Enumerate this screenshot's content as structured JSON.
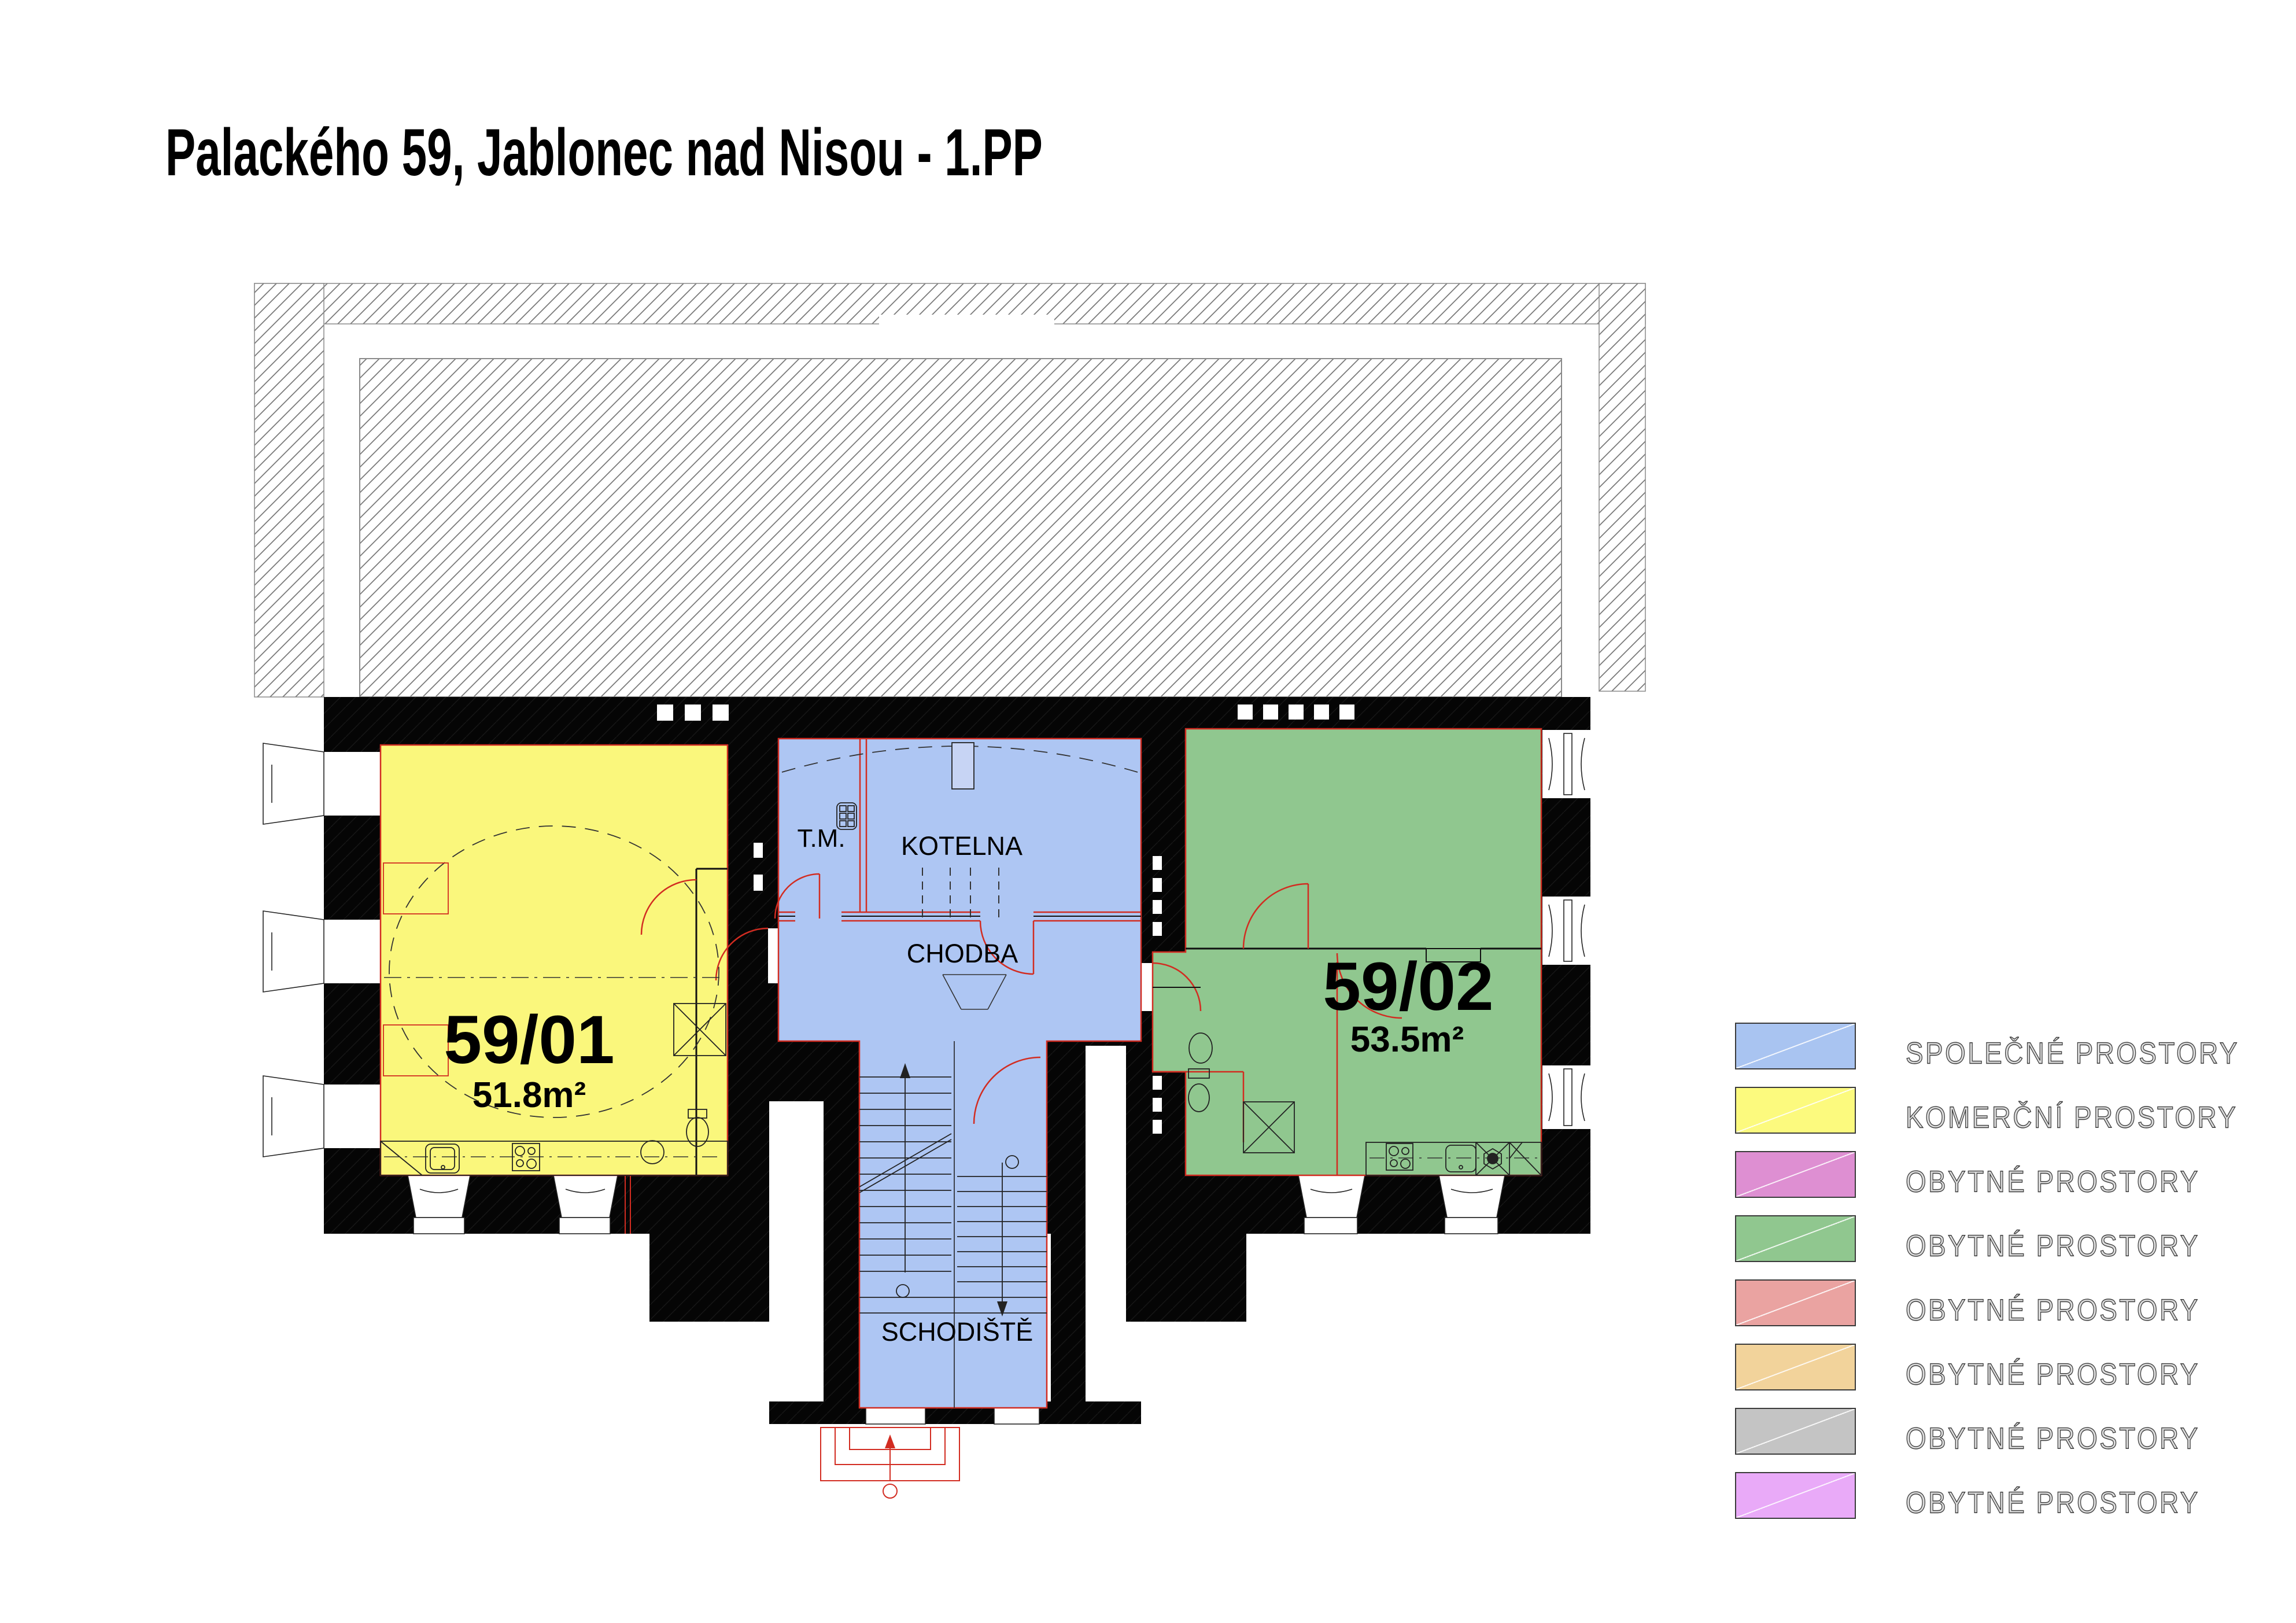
{
  "title": "Palackého 59, Jablonec nad Nisou  - 1.PP",
  "plan": {
    "unit_59_01": {
      "id": "59/01",
      "area": "51.8m²"
    },
    "unit_59_02": {
      "id": "59/02",
      "area": "53.5m²"
    },
    "rooms": {
      "tm": "T.M.",
      "kotelna": "KOTELNA",
      "chodba": "CHODBA",
      "schodiste": "SCHODIŠTĚ"
    },
    "colors": {
      "common": "#aec6f3",
      "commercial": "#faf77c",
      "unit2_green": "#90c78f",
      "door_red": "#d22c21",
      "wall": "#000000"
    }
  },
  "legend": {
    "items": [
      {
        "label": "SPOLEČNÉ PROSTORY",
        "color": "#a9c4f1"
      },
      {
        "label": "KOMERČNÍ PROSTORY",
        "color": "#fcfa7e"
      },
      {
        "label": "OBYTNÉ PROSTORY",
        "color": "#de8fd2"
      },
      {
        "label": "OBYTNÉ PROSTORY",
        "color": "#90c78f"
      },
      {
        "label": "OBYTNÉ PROSTORY",
        "color": "#eaa3a1"
      },
      {
        "label": "OBYTNÉ PROSTORY",
        "color": "#f2d39b"
      },
      {
        "label": "OBYTNÉ PROSTORY",
        "color": "#c4c4c4"
      },
      {
        "label": "OBYTNÉ PROSTORY",
        "color": "#e9aaf8"
      }
    ]
  }
}
